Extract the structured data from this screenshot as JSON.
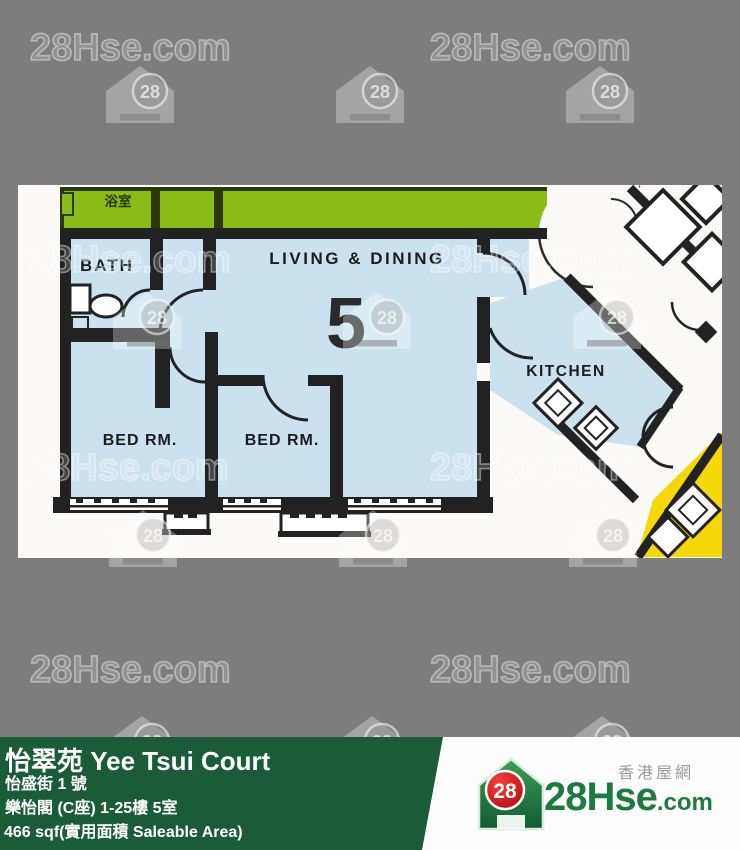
{
  "page": {
    "background": "#7d7d7d"
  },
  "watermark": {
    "text": "28Hse.com",
    "badge": "28",
    "text_positions": [
      [
        30,
        28
      ],
      [
        430,
        28
      ],
      [
        30,
        240
      ],
      [
        430,
        240
      ],
      [
        28,
        448
      ],
      [
        430,
        448
      ],
      [
        30,
        650
      ],
      [
        430,
        650
      ]
    ],
    "icon_positions": [
      [
        103,
        64
      ],
      [
        333,
        64
      ],
      [
        563,
        64
      ],
      [
        110,
        290
      ],
      [
        340,
        290
      ],
      [
        570,
        290
      ],
      [
        106,
        508
      ],
      [
        336,
        508
      ],
      [
        566,
        508
      ],
      [
        105,
        714
      ],
      [
        335,
        714
      ],
      [
        565,
        714
      ]
    ]
  },
  "floorplan": {
    "labels": {
      "bathroom_cjk": "浴室",
      "bath": "BATH",
      "living_dining": "LIVING & DINING",
      "unit_number": "5",
      "kitchen": "KITCHEN",
      "bedroom1": "BED RM.",
      "bedroom2": "BED RM."
    },
    "colors": {
      "unit_fill": "#c9e2ee",
      "common_green": "#8abc17",
      "adjacent_yellow": "#f6d707",
      "wall": "#222222",
      "plan_background": "#fbfaf6"
    }
  },
  "footer": {
    "background": "#1a5c39",
    "estate_name": "怡翠苑 Yee Tsui Court",
    "address": "怡盛街 1 號",
    "block_unit": "樂怡閣 (C座) 1-25樓 5室",
    "area": "466 sqf(實用面積 Saleable Area)"
  },
  "brand": {
    "badge": "28",
    "name_main": "28Hse",
    "name_suffix": ".com",
    "tagline": "香港屋網"
  }
}
